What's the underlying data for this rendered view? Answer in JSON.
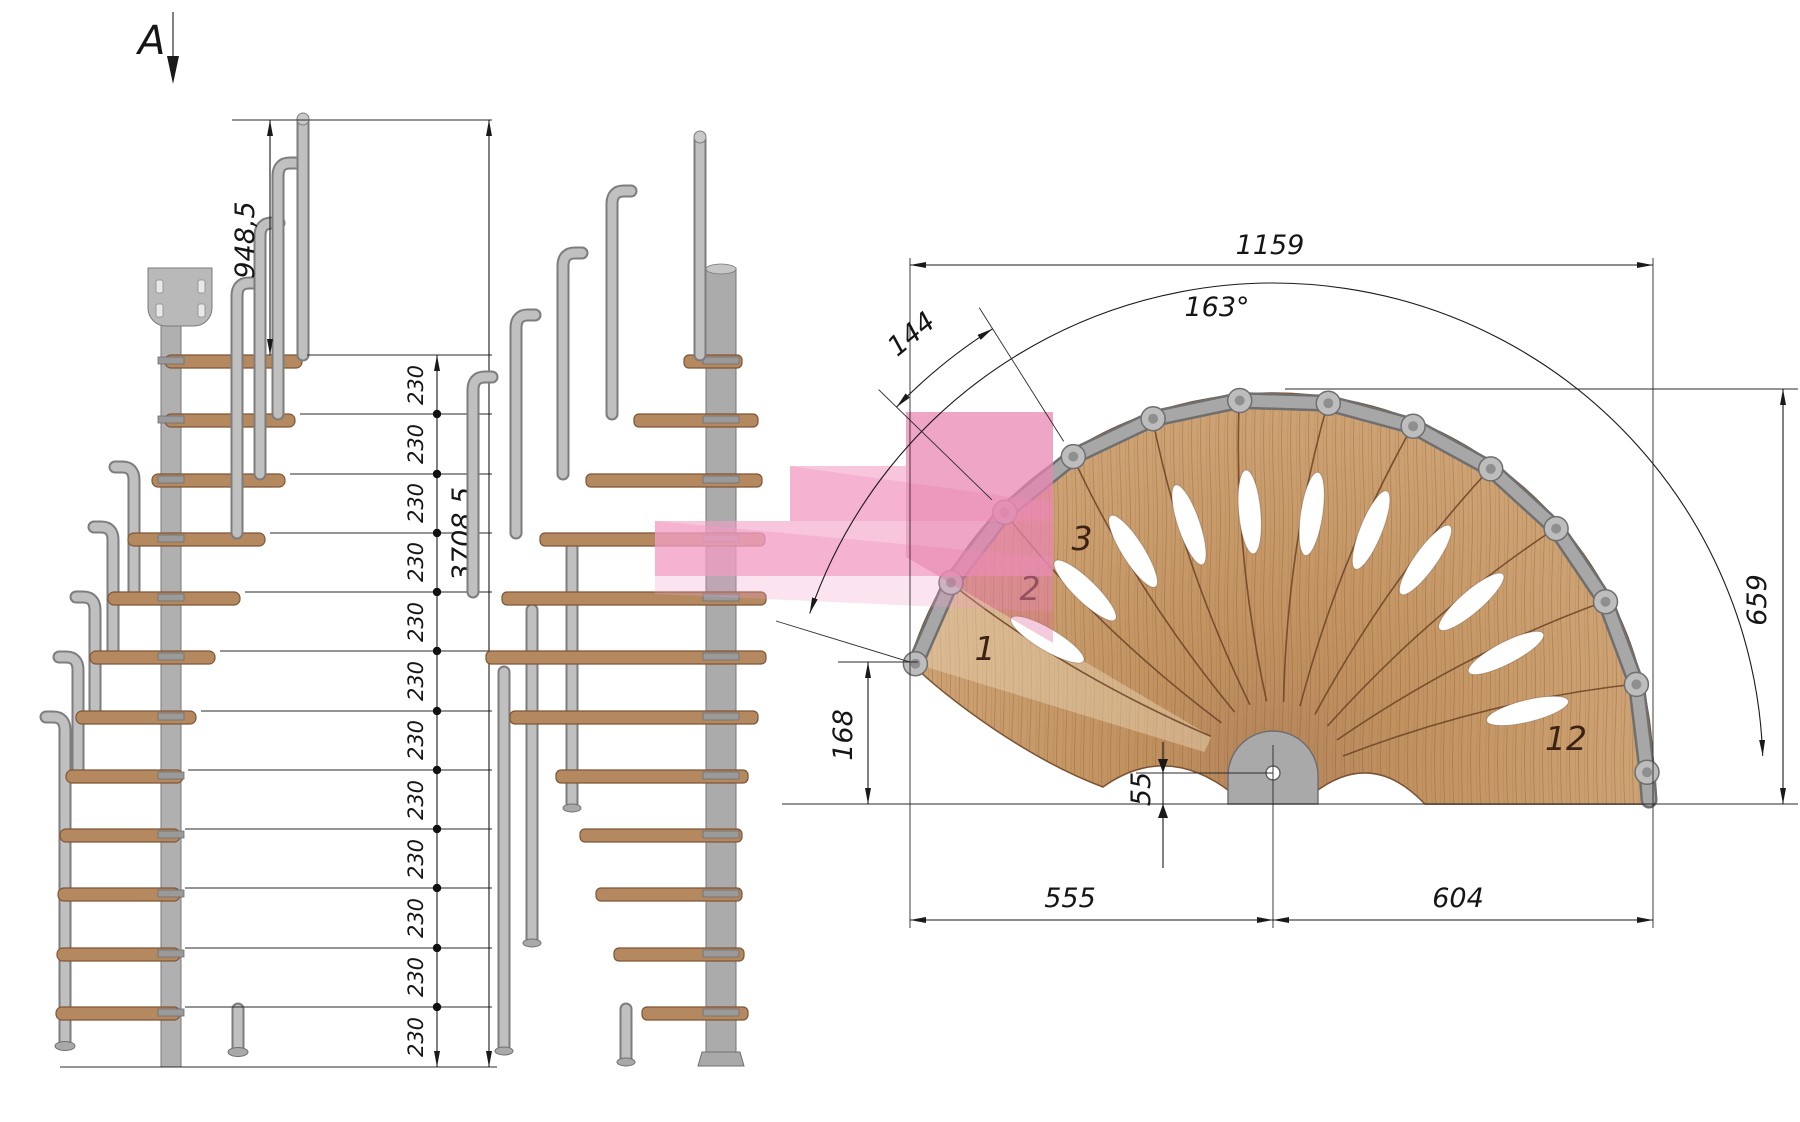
{
  "drawing": {
    "section_label": "A",
    "left_elevation": {
      "dim_handrail_height": "948,5",
      "dim_total_height": "3708,5",
      "dims_230": [
        "230",
        "230",
        "230",
        "230",
        "230",
        "230",
        "230",
        "230",
        "230",
        "230",
        "230",
        "230"
      ]
    },
    "plan": {
      "dim_total_width": "1159",
      "dim_angle": "163°",
      "dim_step_arc": "144",
      "dim_right_height": "659",
      "dim_left_drop": "168",
      "dim_pole_offset": "55",
      "dim_left_span": "555",
      "dim_right_span": "604",
      "step_numbers": {
        "first": "1",
        "second": "2",
        "third": "3",
        "last": "12"
      }
    },
    "colors": {
      "wood": "#c59a6c",
      "steel": "#b3b3b3",
      "highlight_pink": "#f29ec4"
    }
  }
}
